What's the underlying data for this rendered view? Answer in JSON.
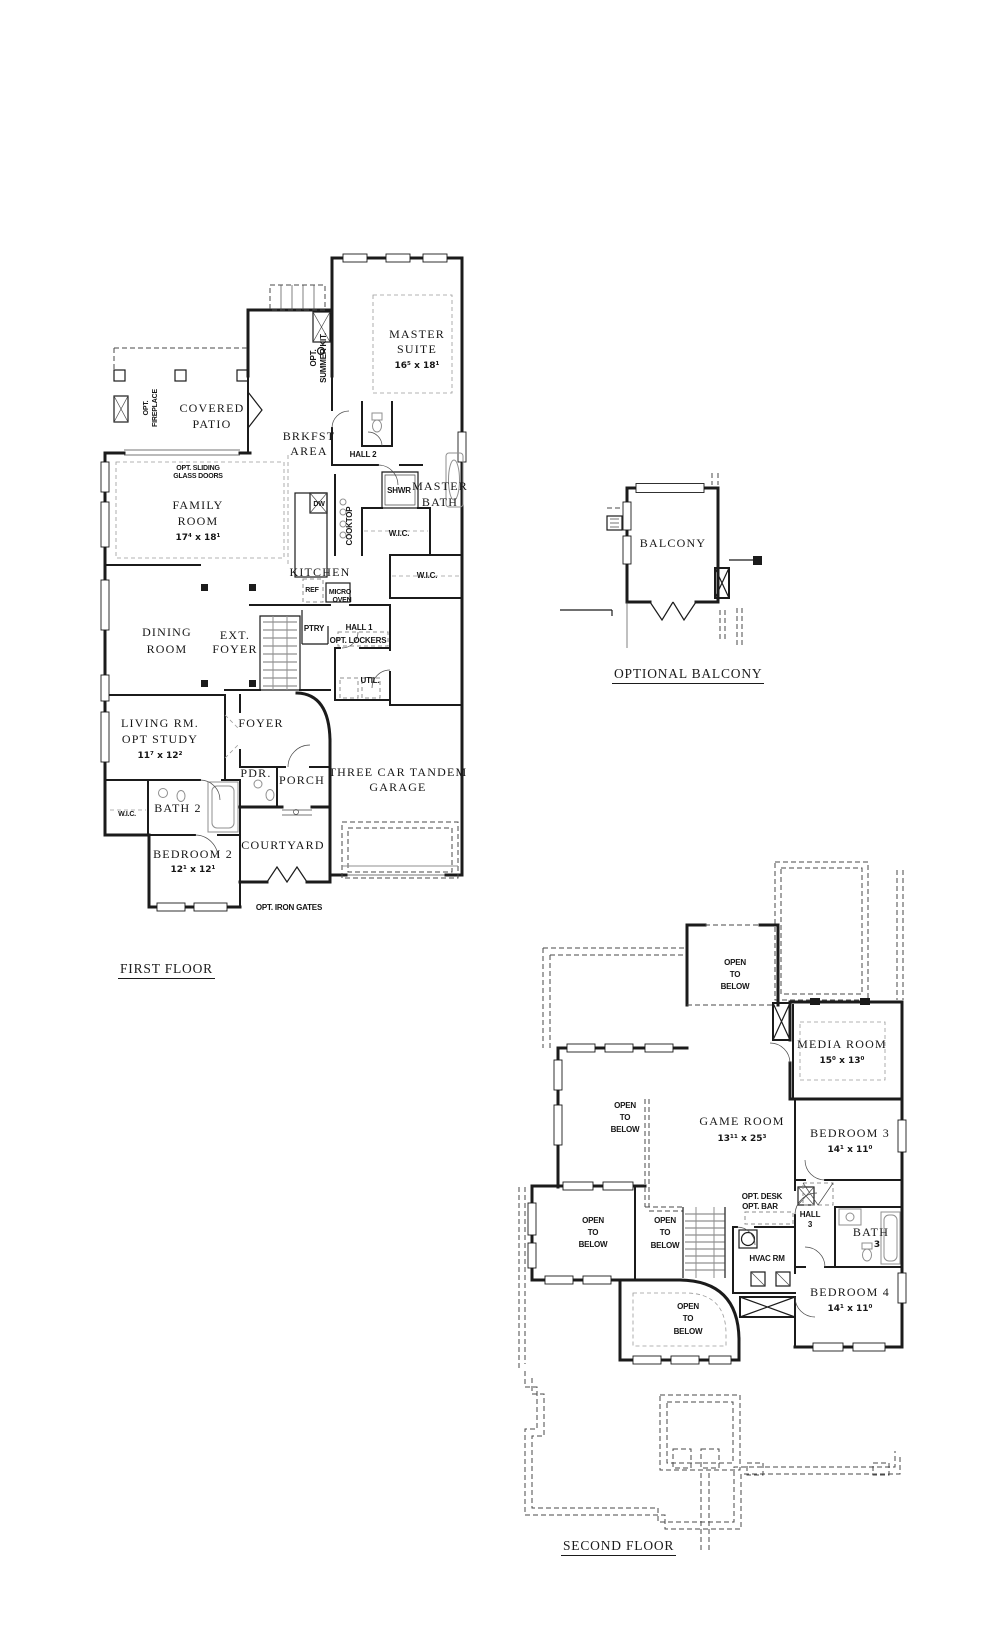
{
  "colors": {
    "ink": "#1b1b1b",
    "gray": "#8f8f8f",
    "background": "#ffffff"
  },
  "first_floor": {
    "title": "FIRST FLOOR",
    "rooms": {
      "master_suite": {
        "name": [
          "MASTER",
          "SUITE"
        ],
        "dims": "16⁵ x 18¹"
      },
      "covered_patio": {
        "name": [
          "COVERED",
          "PATIO"
        ]
      },
      "brkfst_area": {
        "name": [
          "BRKFST",
          "AREA"
        ]
      },
      "family_room": {
        "name": [
          "FAMILY",
          "ROOM"
        ],
        "dims": "17⁴ x 18¹"
      },
      "master_bath": {
        "name": [
          "MASTER",
          "BATH"
        ]
      },
      "kitchen": {
        "name": [
          "KITCHEN"
        ]
      },
      "dining_room": {
        "name": [
          "DINING",
          "ROOM"
        ]
      },
      "ext_foyer": {
        "name": [
          "EXT.",
          "FOYER"
        ]
      },
      "living_study": {
        "name": [
          "LIVING RM.",
          "OPT STUDY"
        ],
        "dims": "11⁷ x 12²"
      },
      "foyer": {
        "name": [
          "FOYER"
        ]
      },
      "garage": {
        "name": [
          "THREE CAR TANDEM",
          "GARAGE"
        ]
      },
      "bedroom_2": {
        "name": [
          "BEDROOM 2"
        ],
        "dims": "12¹ x 12¹"
      },
      "courtyard": {
        "name": [
          "COURTYARD"
        ]
      },
      "porch": {
        "name": [
          "PORCH"
        ]
      },
      "util": {
        "name": [
          "UTIL."
        ]
      }
    },
    "annotations": {
      "opt_fireplace": [
        "OPT.",
        "FIREPLACE"
      ],
      "opt_summer_kit": [
        "OPT.",
        "SUMMER KIT."
      ],
      "opt_sliding_doors": [
        "OPT. SLIDING",
        "GLASS DOORS"
      ],
      "hall_2": "HALL 2",
      "shwr": "SHWR",
      "wic": "W.I.C.",
      "cooktop": "COOKTOP",
      "dw": "DW",
      "ref": "REF",
      "micro_oven": [
        "MICRO",
        "OVEN"
      ],
      "ptry": "PTRY",
      "hall_1": "HALL 1",
      "opt_lockers": "OPT. LOCKERS",
      "pdr": "PDR.",
      "bath_2": "BATH 2",
      "opt_iron_gates": "OPT. IRON GATES"
    }
  },
  "optional_balcony": {
    "title": "OPTIONAL BALCONY",
    "room": "BALCONY"
  },
  "second_floor": {
    "title": "SECOND FLOOR",
    "open_to_below": [
      "OPEN",
      "TO",
      "BELOW"
    ],
    "rooms": {
      "media_room": {
        "name": [
          "MEDIA ROOM"
        ],
        "dims": "15⁰ x 13⁰"
      },
      "game_room": {
        "name": [
          "GAME ROOM"
        ],
        "dims": "13¹¹ x 25³"
      },
      "bedroom_3": {
        "name": [
          "BEDROOM 3"
        ],
        "dims": "14¹ x 11⁰"
      },
      "bedroom_4": {
        "name": [
          "BEDROOM 4"
        ],
        "dims": "14¹ x 11⁰"
      }
    },
    "annotations": {
      "opt_desk": "OPT. DESK",
      "opt_bar": "OPT. BAR",
      "hall_3": [
        "HALL",
        "3"
      ],
      "bath_3": [
        "BATH",
        "3"
      ],
      "hvac": "HVAC RM"
    }
  }
}
